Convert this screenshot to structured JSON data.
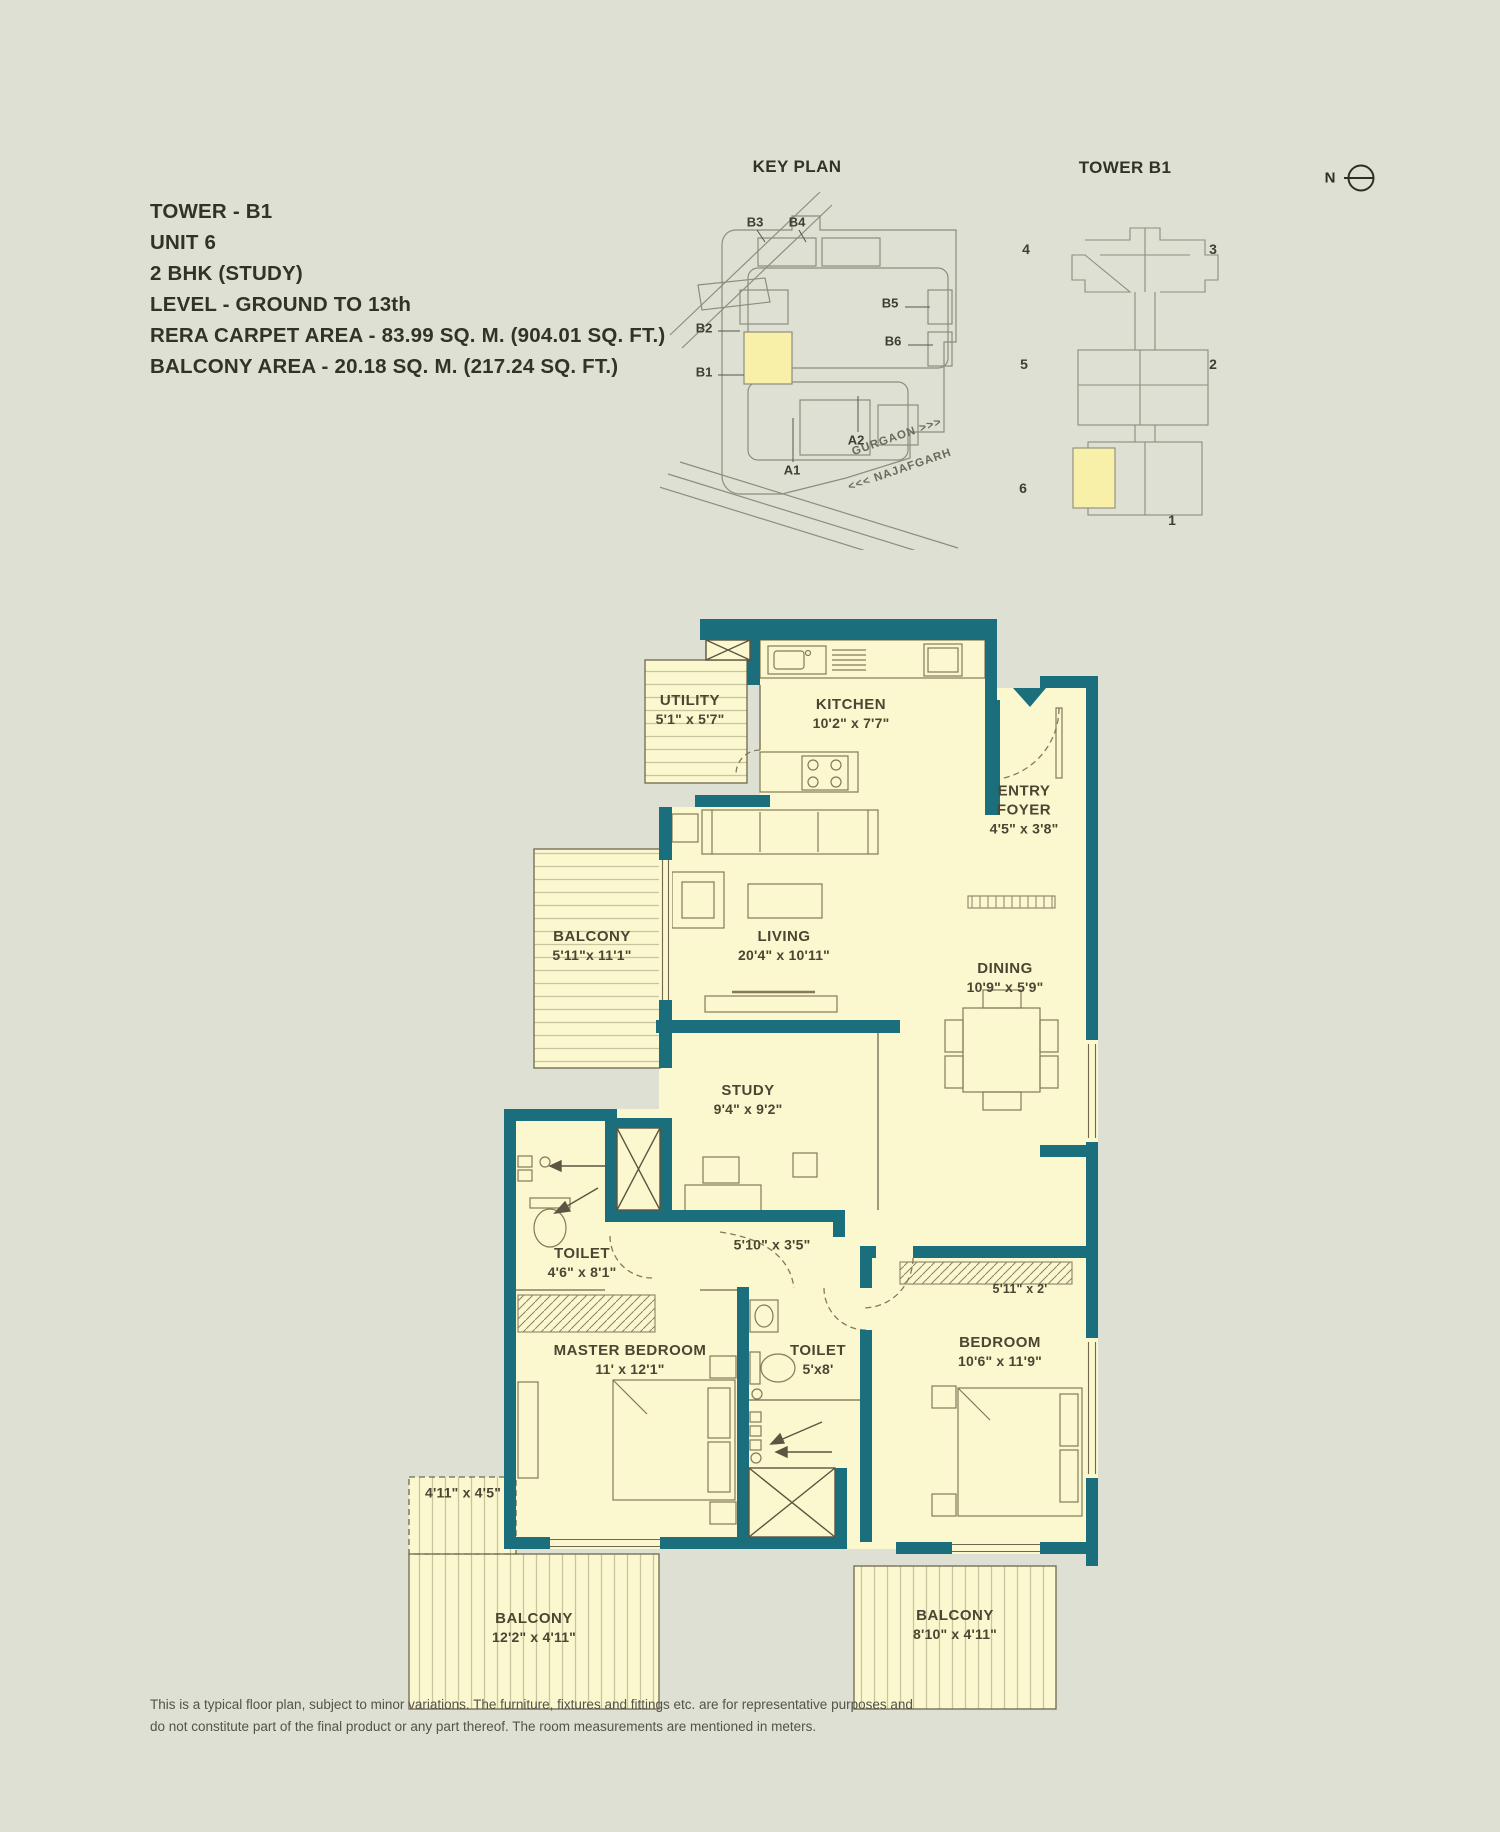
{
  "header": {
    "lines": [
      "TOWER - B1",
      "UNIT 6",
      "2 BHK (STUDY)",
      "LEVEL - GROUND TO 13th",
      "RERA CARPET AREA - 83.99 SQ. M. (904.01 SQ. FT.)",
      "BALCONY AREA - 20.18 SQ. M. (217.24 SQ. FT.)"
    ]
  },
  "key_plan": {
    "title": "KEY PLAN",
    "labels": [
      "B3",
      "B4",
      "B2",
      "B1",
      "B5",
      "B6",
      "A1",
      "A2"
    ],
    "roads": [
      "GURGAON >>>",
      "<<< NAJAFGARH"
    ]
  },
  "tower_plate": {
    "title": "TOWER B1",
    "units": [
      "4",
      "3",
      "5",
      "2",
      "6",
      "1"
    ]
  },
  "north": {
    "label": "N"
  },
  "rooms": {
    "utility": {
      "name": "UTILITY",
      "dim": "5'1\" x 5'7\""
    },
    "kitchen": {
      "name": "KITCHEN",
      "dim": "10'2\" x 7'7\""
    },
    "entry_foyer": {
      "name": "ENTRY FOYER",
      "dim": "4'5\" x 3'8\""
    },
    "balcony_left": {
      "name": "BALCONY",
      "dim": "5'11\"x 11'1\""
    },
    "living": {
      "name": "LIVING",
      "dim": "20'4\" x 10'11\""
    },
    "dining": {
      "name": "DINING",
      "dim": "10'9\" x 5'9\""
    },
    "study": {
      "name": "STUDY",
      "dim": "9'4\" x 9'2\""
    },
    "passage": {
      "dim": "5'10\" x 3'5\""
    },
    "toilet_1": {
      "name": "TOILET",
      "dim": "4'6\" x 8'1\""
    },
    "master_bedroom": {
      "name": "MASTER BEDROOM",
      "dim": "11' x 12'1\""
    },
    "toilet_2": {
      "name": "TOILET",
      "dim": "5'x8'"
    },
    "bedroom": {
      "name": "BEDROOM",
      "dim": "10'6\" x 11'9\""
    },
    "bedroom_wardrobe": {
      "dim": "5'11\" x 2'"
    },
    "small_balcony": {
      "dim": "4'11\" x 4'5\""
    },
    "balcony_bottom_left": {
      "name": "BALCONY",
      "dim": "12'2\" x 4'11\""
    },
    "balcony_bottom_right": {
      "name": "BALCONY",
      "dim": "8'10\" x 4'11\""
    }
  },
  "colors": {
    "wall": "#1b6f7c",
    "room": "#fbf8cf",
    "background": "#dee0d4",
    "highlight": "#f8f0a8"
  },
  "disclaimer": {
    "lines": [
      "This is a typical floor plan, subject to minor variations. The furniture, fixtures and fittings etc. are for representative purposes and",
      "do not constitute part of the final product or any part thereof. The room measurements are mentioned in meters."
    ]
  }
}
